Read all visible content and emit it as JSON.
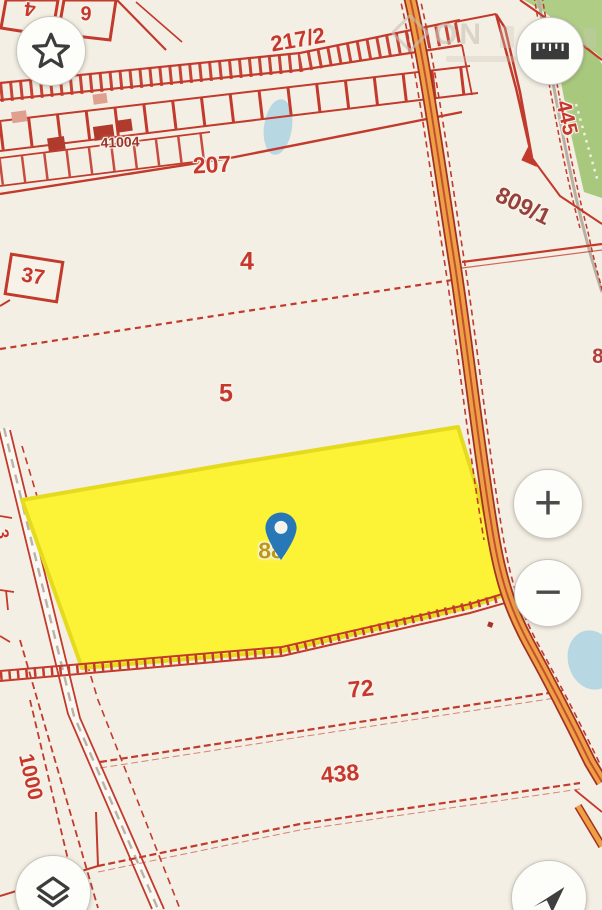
{
  "watermark": {
    "logo": "diamond-logo-icon",
    "text": "ON"
  },
  "controls": {
    "favorite": {
      "icon": "star-icon"
    },
    "measure": {
      "icon": "ruler-icon"
    },
    "zoom_in": {
      "icon": "plus-icon",
      "symbol": "+"
    },
    "zoom_out": {
      "icon": "minus-icon",
      "symbol": "−"
    },
    "layers": {
      "icon": "layers-icon"
    },
    "locate": {
      "icon": "navigation-arrow-icon"
    }
  },
  "map": {
    "colors": {
      "background": "#f4efe4",
      "boundary": "#c6372d",
      "boundary_dark": "#a93226",
      "road_orange": "#ef9f45",
      "road_gray": "#b9b3a8",
      "water": "#b7d8e3",
      "vegetation": "#aecb85",
      "highlight_fill": "#fcf336",
      "highlight_stroke": "#e6da1e",
      "pin_blue": "#2878b8",
      "selected_label": "#bd9a15"
    },
    "selected_parcel": {
      "label": "88",
      "pin_icon": "map-pin-icon"
    },
    "labels": [
      {
        "text": "4",
        "x": 30,
        "y": 8,
        "rot": 187,
        "size": 20
      },
      {
        "text": "6",
        "x": 86,
        "y": 12,
        "rot": 183,
        "size": 20
      },
      {
        "text": "217/2",
        "x": 298,
        "y": 40,
        "rot": -10,
        "size": 22
      },
      {
        "text": "445",
        "x": 566,
        "y": 118,
        "rot": 77,
        "size": 21
      },
      {
        "text": "41004",
        "x": 120,
        "y": 142,
        "rot": -2,
        "size": 14,
        "color": "#9c332c"
      },
      {
        "text": "207",
        "x": 212,
        "y": 165,
        "rot": -3,
        "size": 23
      },
      {
        "text": "809/1",
        "x": 523,
        "y": 206,
        "rot": 26,
        "size": 23,
        "color": "#96413c"
      },
      {
        "text": "37",
        "x": 33,
        "y": 277,
        "rot": 9,
        "size": 21
      },
      {
        "text": "4",
        "x": 247,
        "y": 262,
        "rot": 0,
        "size": 25
      },
      {
        "text": "5",
        "x": 226,
        "y": 394,
        "rot": 0,
        "size": 25
      },
      {
        "text": "8",
        "x": 598,
        "y": 357,
        "rot": 0,
        "size": 21,
        "color": "#b2403f"
      },
      {
        "text": "88",
        "x": 271,
        "y": 551,
        "rot": 0,
        "size": 23,
        "color": "#bd9a15"
      },
      {
        "text": "72",
        "x": 361,
        "y": 689,
        "rot": -6,
        "size": 23
      },
      {
        "text": "438",
        "x": 340,
        "y": 774,
        "rot": -5,
        "size": 23
      },
      {
        "text": "1000",
        "x": 30,
        "y": 777,
        "rot": 77,
        "size": 21
      },
      {
        "text": "3",
        "x": 2,
        "y": 534,
        "rot": 80,
        "size": 17
      }
    ]
  }
}
